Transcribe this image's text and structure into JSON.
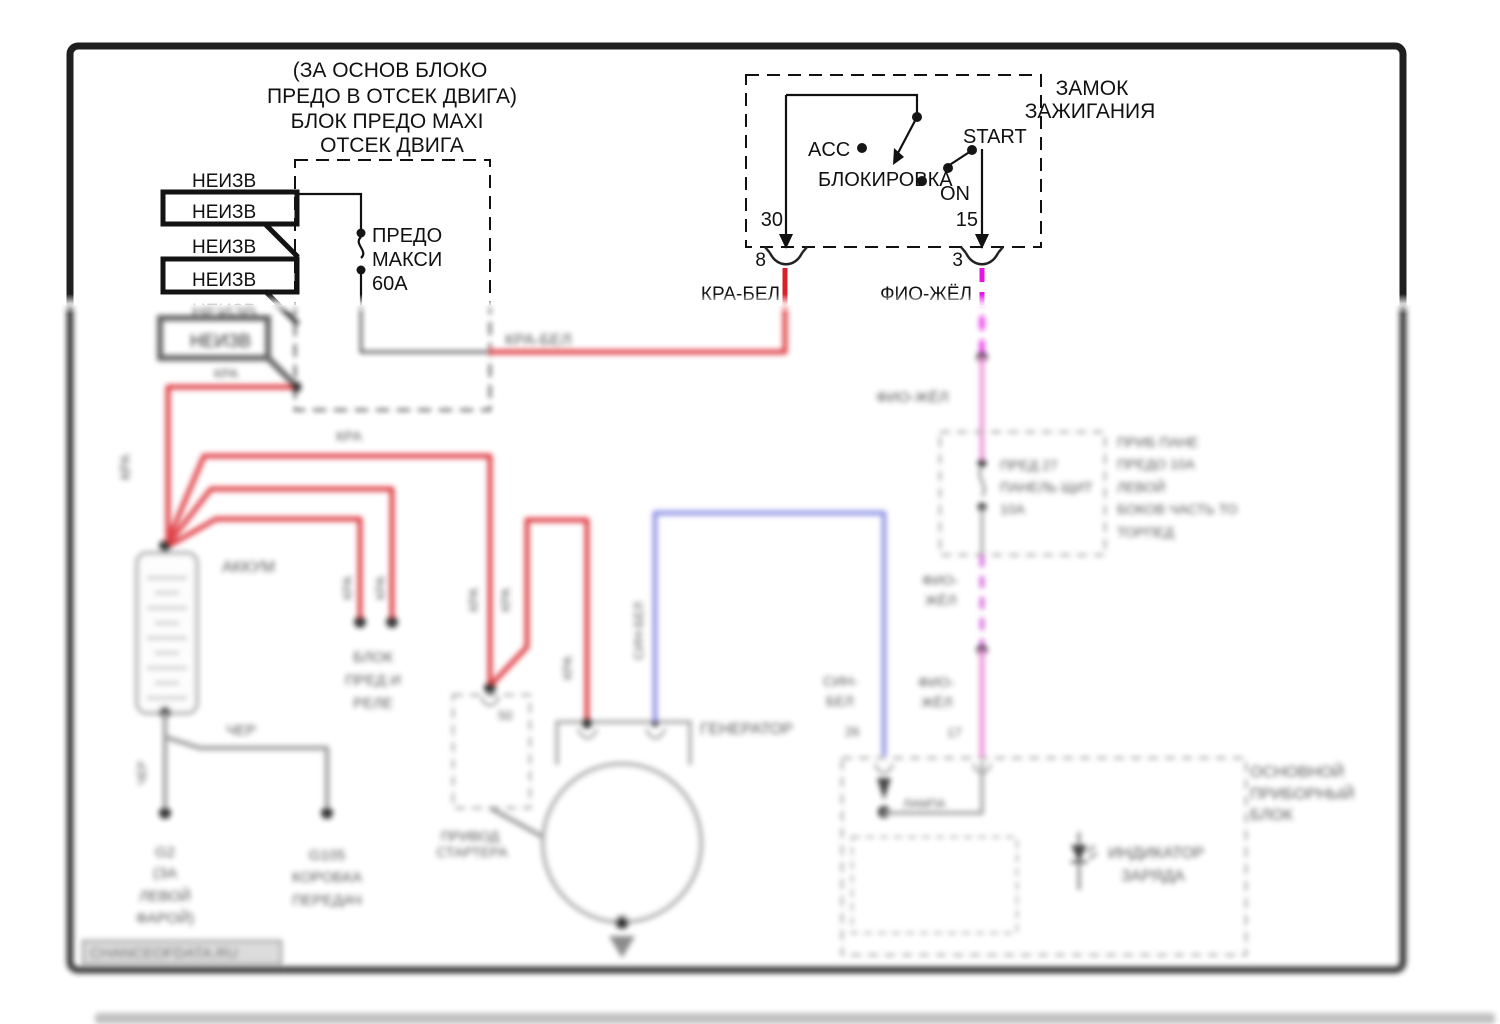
{
  "colors": {
    "red": "#da2129",
    "magenta": "#e316e3",
    "violet_dash": "#cf4fd6",
    "pink": "#ea80d2",
    "blue": "#8487e2",
    "wire_gray": "#8f8f8f",
    "frame": "#1f1f1f",
    "dark_flag": "#4a4a4a"
  },
  "engine_fuse_box": {
    "title": [
      "(ЗА ОСНОВ БЛОКО",
      "ПРЕДО В ОТСЕК ДВИГА)",
      "БЛОК ПРЕДО MAXI",
      "ОТСЕК ДВИГА"
    ],
    "fuse": [
      "ПРЕДО",
      "МАКСИ",
      "60А"
    ]
  },
  "labels": {
    "neizv": "НЕИЗВ",
    "kra": "КРА",
    "kra_bel": "КРА-БЕЛ",
    "fio_zhel": "ФИО-ЖЁЛ",
    "cher": "ЧЕР",
    "sin_bel": "СИН-БЕЛ",
    "fio": "ФИО-",
    "zhel": "ЖЁЛ",
    "sin": "СИН-",
    "bel": "БЕЛ"
  },
  "ignition": {
    "title": [
      "ЗАМОК",
      "ЗАЖИГАНИЯ"
    ],
    "acc": "ACC",
    "lock": "БЛОКИРОВКА",
    "start": "START",
    "on": "ON",
    "t30": "30",
    "t15": "15",
    "pin8": "8",
    "pin3": "3"
  },
  "battery": {
    "name": "АККУМ"
  },
  "grounds": {
    "left": [
      "G2",
      "(ЗА",
      "ЛЕВОЙ",
      "ФАРОЙ)"
    ],
    "right": [
      "G105",
      "КОРОБКА",
      "ПЕРЕДАЧ"
    ]
  },
  "fuse_relay_block": [
    "БЛОК",
    "ПРЕД И",
    "РЕЛЕ"
  ],
  "starter": {
    "pin": "50",
    "label": [
      "ПРИВОД",
      "СТАРТЕРА"
    ]
  },
  "generator": {
    "label": "ГЕНЕРАТОР"
  },
  "panel_fuse": {
    "inside": [
      "ПРЕД 27",
      "ПАНЕЛЬ ЩИТ",
      "10А"
    ],
    "note": [
      "ПРИБ ПАНЕ",
      "ПРЕДО 10А",
      "ЛЕВОЙ",
      "БОКОВ ЧАСТЬ ТО",
      "ТОРПЕД"
    ],
    "pin17": "17"
  },
  "cluster": {
    "name": [
      "ОСНОВНОЙ",
      "ПРИБОРНЫЙ",
      "БЛОК"
    ],
    "indicator": [
      "ИНДИКАТОР",
      "ЗАРЯДА"
    ],
    "lamp": "ЛАМПА",
    "pin26": "26"
  },
  "watermark": "CHANCEOFDATA.RU"
}
